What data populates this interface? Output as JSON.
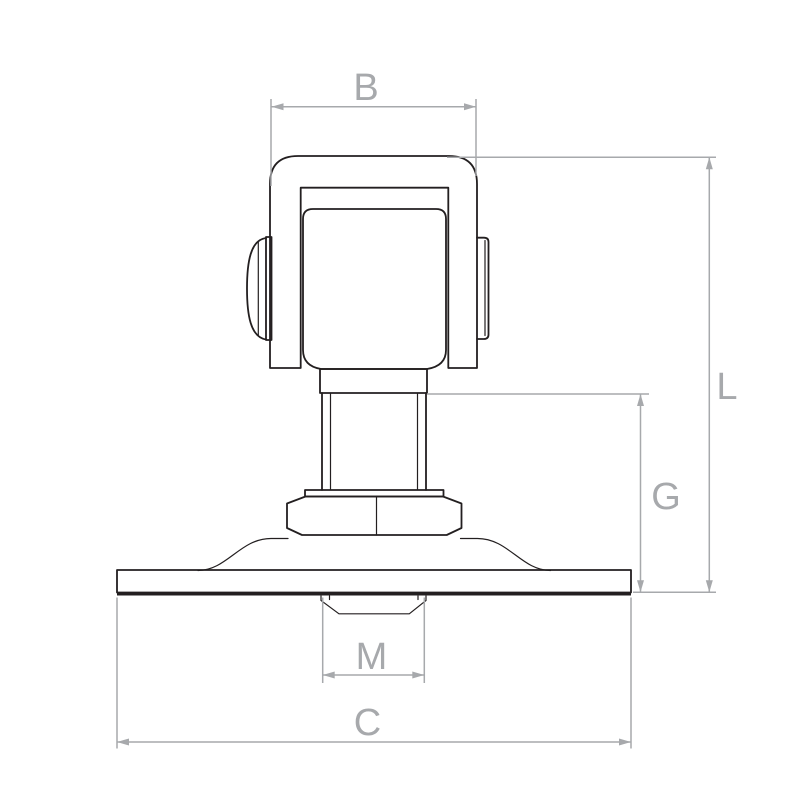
{
  "drawing": {
    "kind": "technical dimension drawing",
    "view": "front elevation of swivel hinge with flange plate"
  },
  "dimensions": {
    "b": {
      "label": "B"
    },
    "l": {
      "label": "L"
    },
    "g": {
      "label": "G"
    },
    "m": {
      "label": "M"
    },
    "c": {
      "label": "C"
    }
  },
  "colors": {
    "part_outline": "#231f20",
    "dimension_lines": "#a7a9ac",
    "background": "#ffffff"
  }
}
